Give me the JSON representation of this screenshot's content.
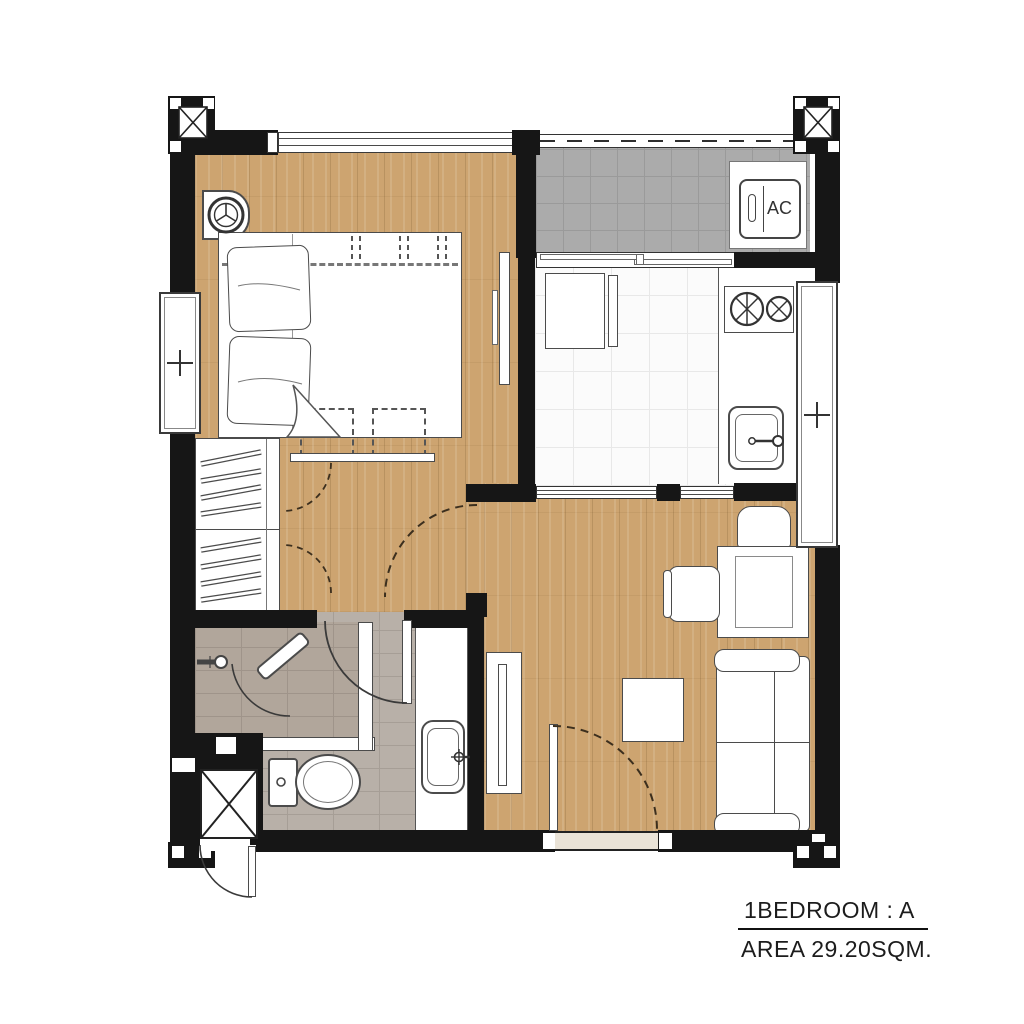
{
  "plan_label": {
    "unit_type": "1BEDROOM : A",
    "area": "AREA 29.20SQM."
  },
  "fixtures": {
    "ac_label": "AC"
  },
  "colors": {
    "wall": "#161616",
    "wood_floor": "#cda470",
    "balcony_tile": "#ababab",
    "kitchen_tile": "#fbfbfb",
    "bathroom_tile": "#b8b0a8",
    "outline": "#4b4b4b"
  }
}
